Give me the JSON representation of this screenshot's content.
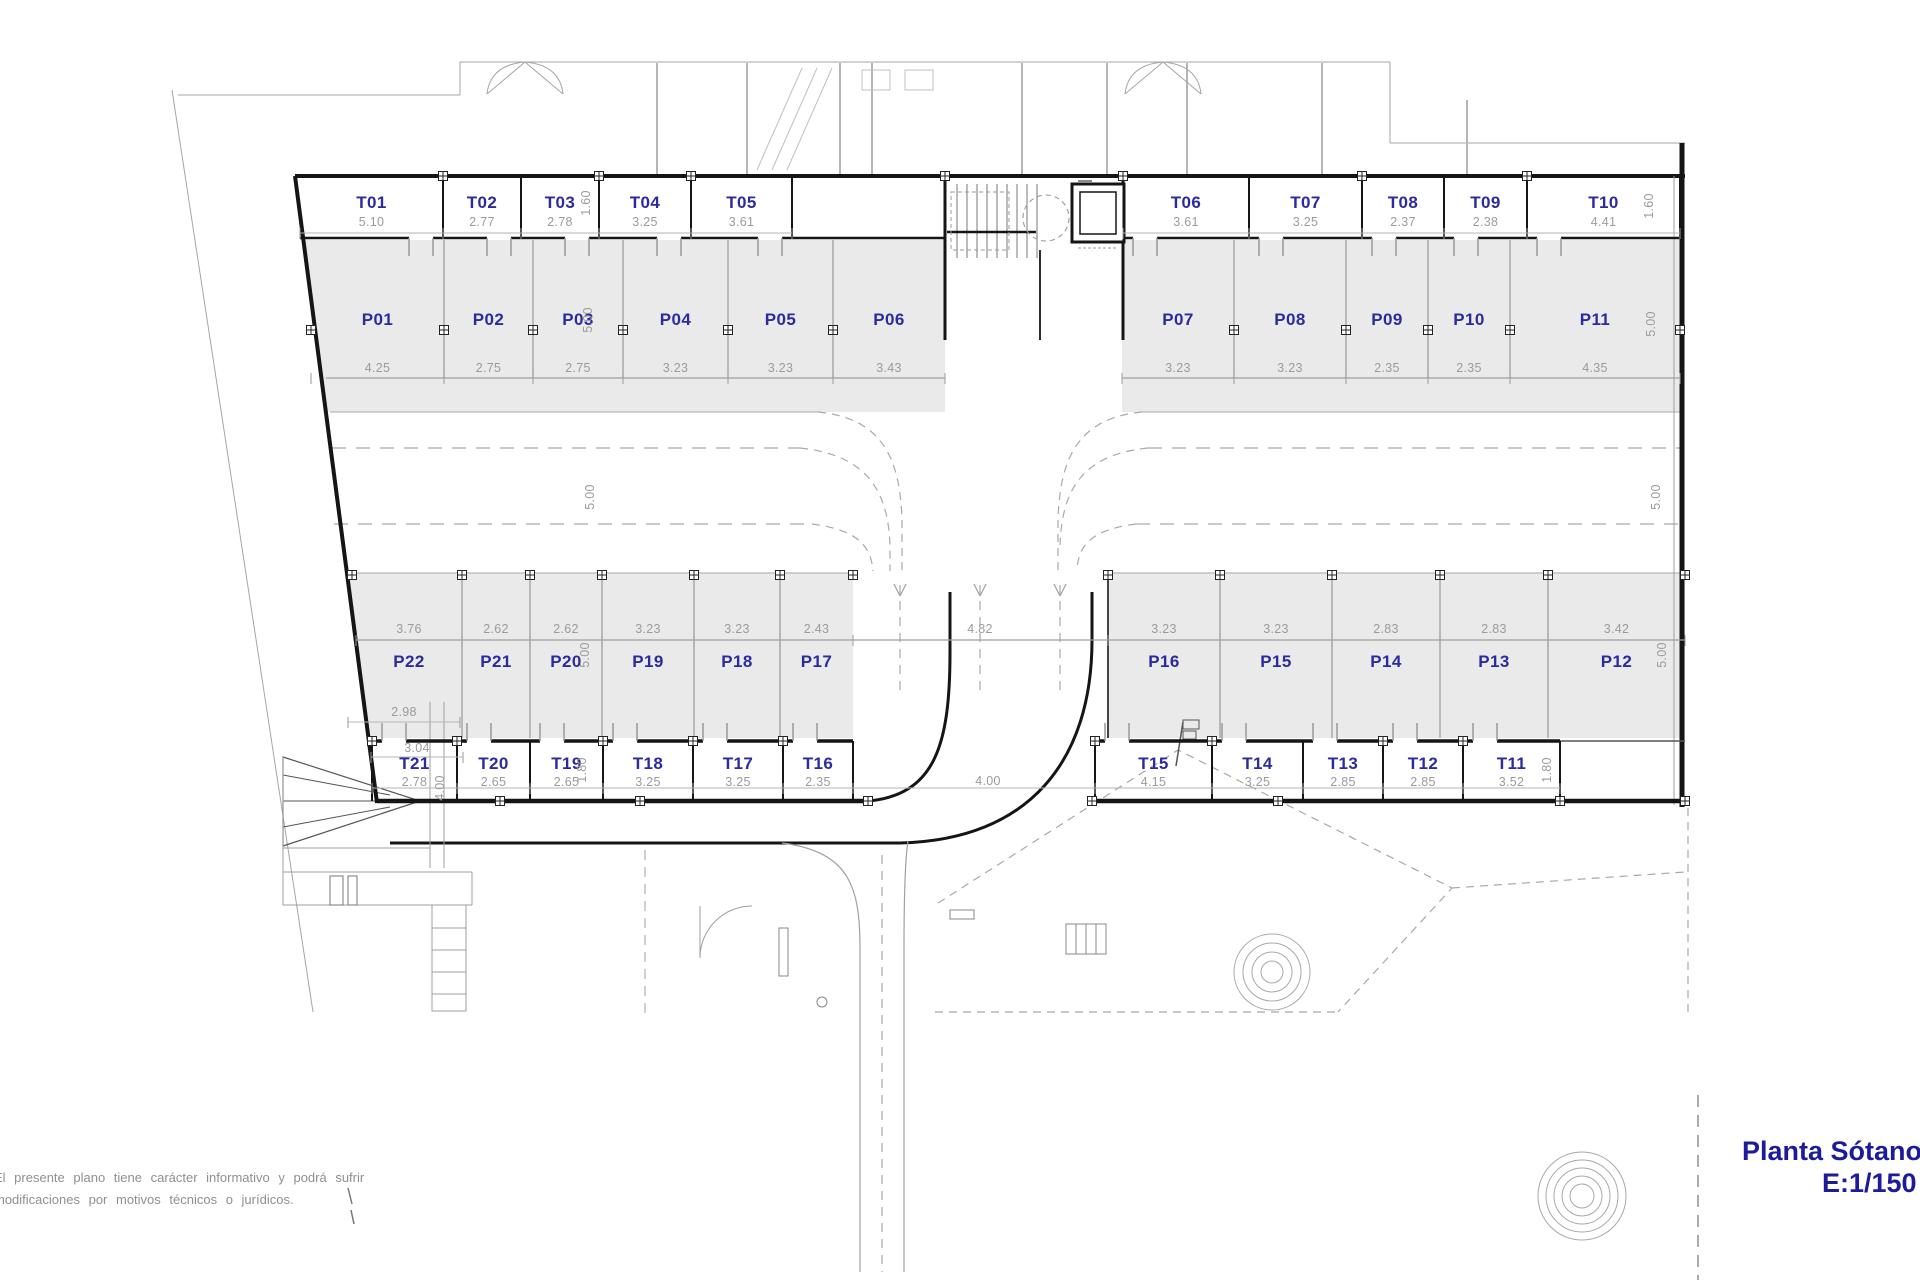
{
  "title": {
    "name": "Planta Sótano",
    "scale": "E:1/150"
  },
  "disclaimer": {
    "line1": "El presente plano tiene carácter informativo y podrá sufrir",
    "line2": "modificaciones por motivos técnicos o jurídicos."
  },
  "colors": {
    "label": "#2b2b9e",
    "dim": "#9b9b9b",
    "stall_fill": "#eaeaea",
    "wall": "#151515",
    "title": "#1b1b9b"
  },
  "bands": {
    "top": {
      "storage_left": [
        {
          "id": "T01",
          "dim": "5.10"
        },
        {
          "id": "T02",
          "dim": "2.77"
        },
        {
          "id": "T03",
          "dim": "2.78"
        },
        {
          "id": "T04",
          "dim": "3.25"
        },
        {
          "id": "T05",
          "dim": "3.61"
        }
      ],
      "storage_right": [
        {
          "id": "T06",
          "dim": "3.61"
        },
        {
          "id": "T07",
          "dim": "3.25"
        },
        {
          "id": "T08",
          "dim": "2.37"
        },
        {
          "id": "T09",
          "dim": "2.38"
        },
        {
          "id": "T10",
          "dim": "4.41"
        }
      ],
      "storage_depth_left": "1.60",
      "storage_depth_right": "1.60",
      "parking_left": [
        {
          "id": "P01",
          "dim": "4.25"
        },
        {
          "id": "P02",
          "dim": "2.75"
        },
        {
          "id": "P03",
          "dim": "2.75"
        },
        {
          "id": "P04",
          "dim": "3.23"
        },
        {
          "id": "P05",
          "dim": "3.23"
        },
        {
          "id": "P06",
          "dim": "3.43"
        }
      ],
      "parking_right": [
        {
          "id": "P07",
          "dim": "3.23"
        },
        {
          "id": "P08",
          "dim": "3.23"
        },
        {
          "id": "P09",
          "dim": "2.35"
        },
        {
          "id": "P10",
          "dim": "2.35"
        },
        {
          "id": "P11",
          "dim": "4.35"
        }
      ],
      "parking_depth_left": "5.00",
      "parking_depth_right": "5.00"
    },
    "lane": {
      "width_left": "5.00",
      "width_right": "5.00"
    },
    "bottom": {
      "parking_left": [
        {
          "id": "P22",
          "dim": "3.76"
        },
        {
          "id": "P21",
          "dim": "2.62"
        },
        {
          "id": "P20",
          "dim": "2.62"
        },
        {
          "id": "P19",
          "dim": "3.23"
        },
        {
          "id": "P18",
          "dim": "3.23"
        },
        {
          "id": "P17",
          "dim": "2.43"
        }
      ],
      "aisle_width": "4.82",
      "parking_right": [
        {
          "id": "P16",
          "dim": "3.23"
        },
        {
          "id": "P15",
          "dim": "3.23"
        },
        {
          "id": "P14",
          "dim": "2.83"
        },
        {
          "id": "P13",
          "dim": "2.83"
        },
        {
          "id": "P12",
          "dim": "3.42"
        }
      ],
      "parking_depth_left": "5.00",
      "parking_depth_right": "5.00",
      "p22_front_width": "2.98",
      "t21_back_width": "3.04",
      "storage_left": [
        {
          "id": "T21",
          "dim": "2.78"
        },
        {
          "id": "T20",
          "dim": "2.65"
        },
        {
          "id": "T19",
          "dim": "2.65"
        },
        {
          "id": "T18",
          "dim": "3.25"
        },
        {
          "id": "T17",
          "dim": "3.25"
        },
        {
          "id": "T16",
          "dim": "2.35"
        }
      ],
      "exit_width": "4.00",
      "storage_right": [
        {
          "id": "T15",
          "dim": "4.15"
        },
        {
          "id": "T14",
          "dim": "3.25"
        },
        {
          "id": "T13",
          "dim": "2.85"
        },
        {
          "id": "T12",
          "dim": "2.85"
        },
        {
          "id": "T11",
          "dim": "3.52"
        }
      ],
      "storage_depth_left": "1.80",
      "storage_depth_right": "1.80",
      "ramp_width": "4.00"
    }
  }
}
